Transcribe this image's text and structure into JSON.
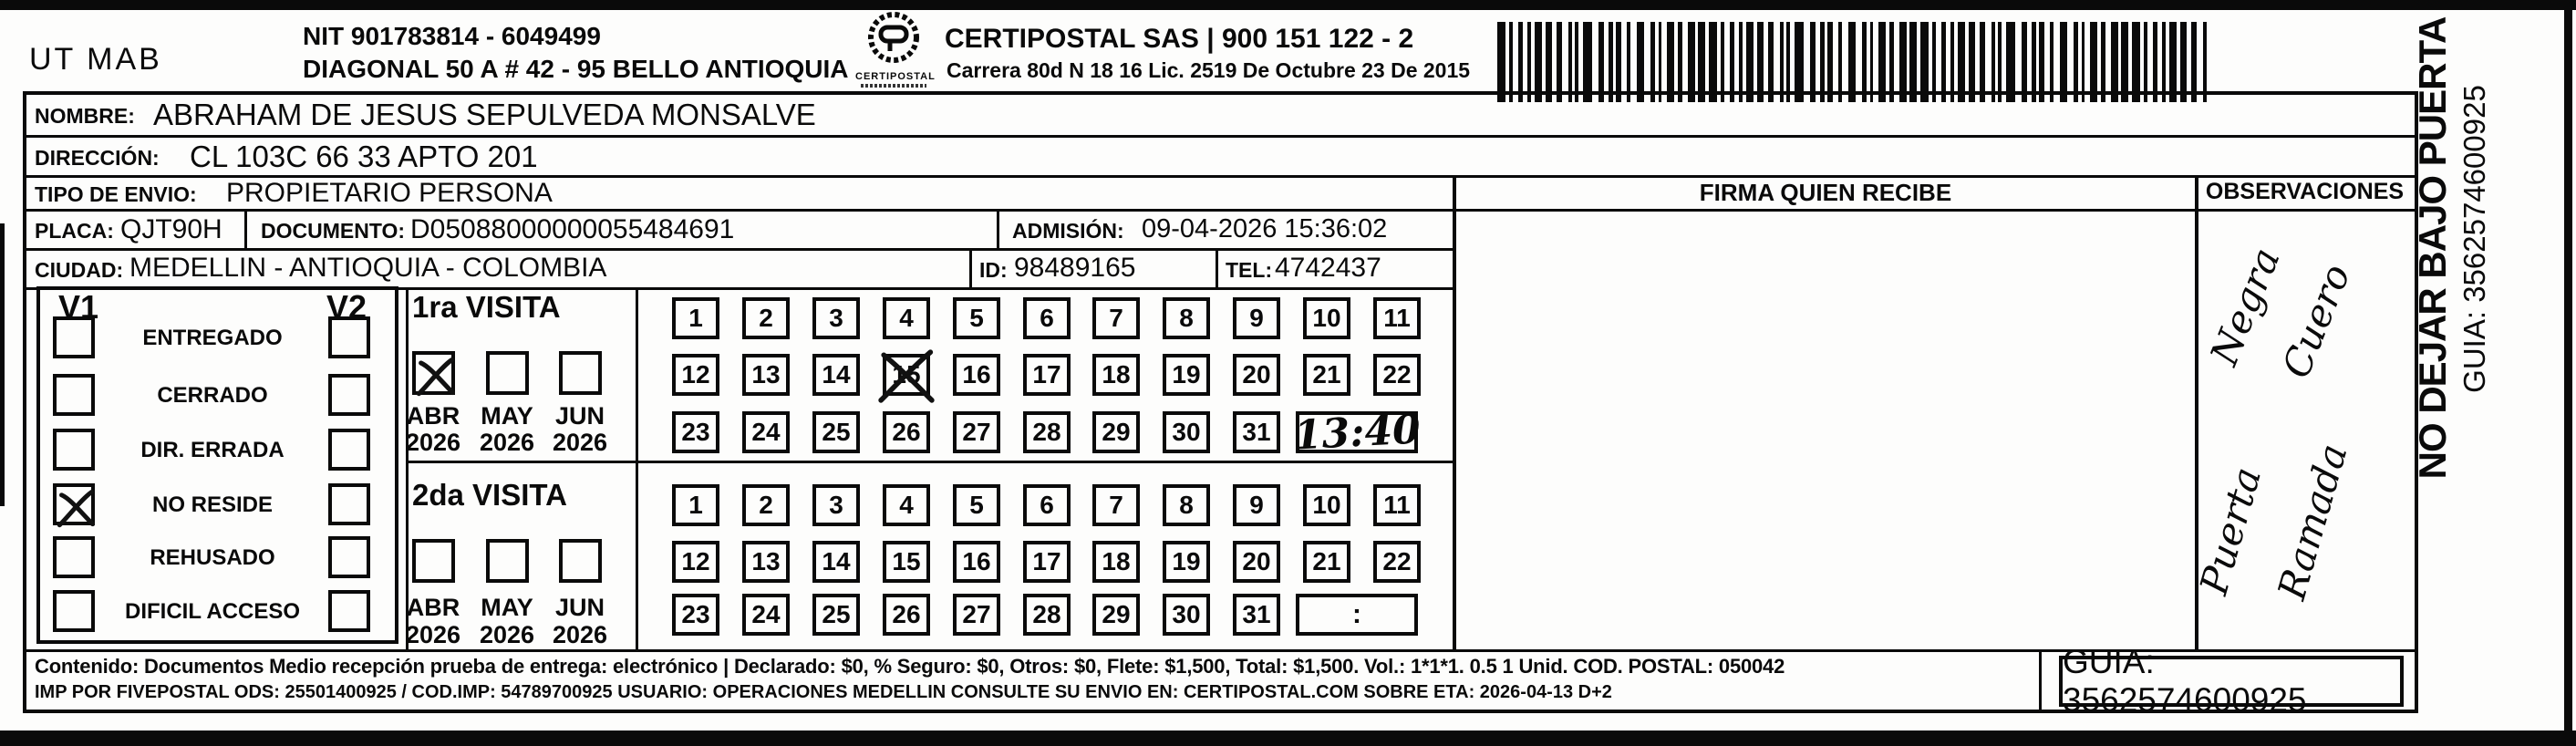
{
  "header": {
    "unit": "UT MAB",
    "nit": "NIT 901783814 - 6049499",
    "address": "DIAGONAL 50 A # 42 - 95  BELLO  ANTIOQUIA",
    "logo_text": "CERTIPOSTAL",
    "company": "CERTIPOSTAL SAS | 900 151 122 - 2",
    "license": "Carrera 80d N 18 16  Lic. 2519 De Octubre 23 De 2015"
  },
  "shipment": {
    "nombre_label": "NOMBRE:",
    "nombre": "ABRAHAM DE JESUS SEPULVEDA MONSALVE",
    "direccion_label": "DIRECCIÓN:",
    "direccion": "CL 103C 66 33 APTO 201",
    "tipo_label": "TIPO DE ENVIO:",
    "tipo": "PROPIETARIO PERSONA",
    "placa_label": "PLACA:",
    "placa": "QJT90H",
    "documento_label": "DOCUMENTO:",
    "documento": "D05088000000055484691",
    "admision_label": "ADMISIÓN:",
    "admision": "09-04-2026 15:36:02",
    "ciudad_label": "CIUDAD:",
    "ciudad": "MEDELLIN - ANTIOQUIA - COLOMBIA",
    "id_label": "ID:",
    "id_value": "98489165",
    "tel_label": "TEL:",
    "tel": "4742437"
  },
  "firma_header": "FIRMA QUIEN RECIBE",
  "observaciones": {
    "header": "OBSERVACIONES",
    "notes": [
      "Negra",
      "Cuero",
      "Puerta",
      "Ramada"
    ]
  },
  "status": {
    "v1_header": "V1",
    "v2_header": "V2",
    "options": [
      {
        "label": "ENTREGADO",
        "v1": false,
        "v2": false
      },
      {
        "label": "CERRADO",
        "v1": false,
        "v2": false
      },
      {
        "label": "DIR. ERRADA",
        "v1": false,
        "v2": false
      },
      {
        "label": "NO RESIDE",
        "v1": true,
        "v2": false
      },
      {
        "label": "REHUSADO",
        "v1": false,
        "v2": false
      },
      {
        "label": "DIFICIL ACCESO",
        "v1": false,
        "v2": false
      }
    ]
  },
  "visits": [
    {
      "title": "1ra VISITA",
      "months": [
        "ABR",
        "MAY",
        "JUN"
      ],
      "year": "2026",
      "checked_month": "ABR",
      "crossed_day": 15,
      "time": "13:40",
      "time_handwritten": true
    },
    {
      "title": "2da VISITA",
      "months": [
        "ABR",
        "MAY",
        "JUN"
      ],
      "year": "2026",
      "checked_month": null,
      "crossed_day": null,
      "time": ":",
      "time_handwritten": false
    }
  ],
  "day_numbers": {
    "row1": [
      "1",
      "2",
      "3",
      "4",
      "5",
      "6",
      "7",
      "8",
      "9",
      "10",
      "11"
    ],
    "row2": [
      "12",
      "13",
      "14",
      "15",
      "16",
      "17",
      "18",
      "19",
      "20",
      "21",
      "22"
    ],
    "row3": [
      "23",
      "24",
      "25",
      "26",
      "27",
      "28",
      "29",
      "30",
      "31"
    ]
  },
  "footer": {
    "line1": "Contenido: Documentos Medio recepción prueba de entrega: electrónico | Declarado: $0, % Seguro: $0, Otros: $0, Flete: $1,500, Total: $1,500. Vol.: 1*1*1. 0.5  1 Unid. COD. POSTAL: 050042",
    "line2": "IMP POR FIVEPOSTAL ODS: 25501400925 / COD.IMP: 54789700925 USUARIO: OPERACIONES MEDELLIN CONSULTE SU ENVIO EN: CERTIPOSTAL.COM SOBRE ETA: 2026-04-13 D+2",
    "guia_box": "GUIA: 3562574600925"
  },
  "side": {
    "warning": "NO DEJAR BAJO PUERTA",
    "guia": "GUIA: 3562574600925"
  }
}
